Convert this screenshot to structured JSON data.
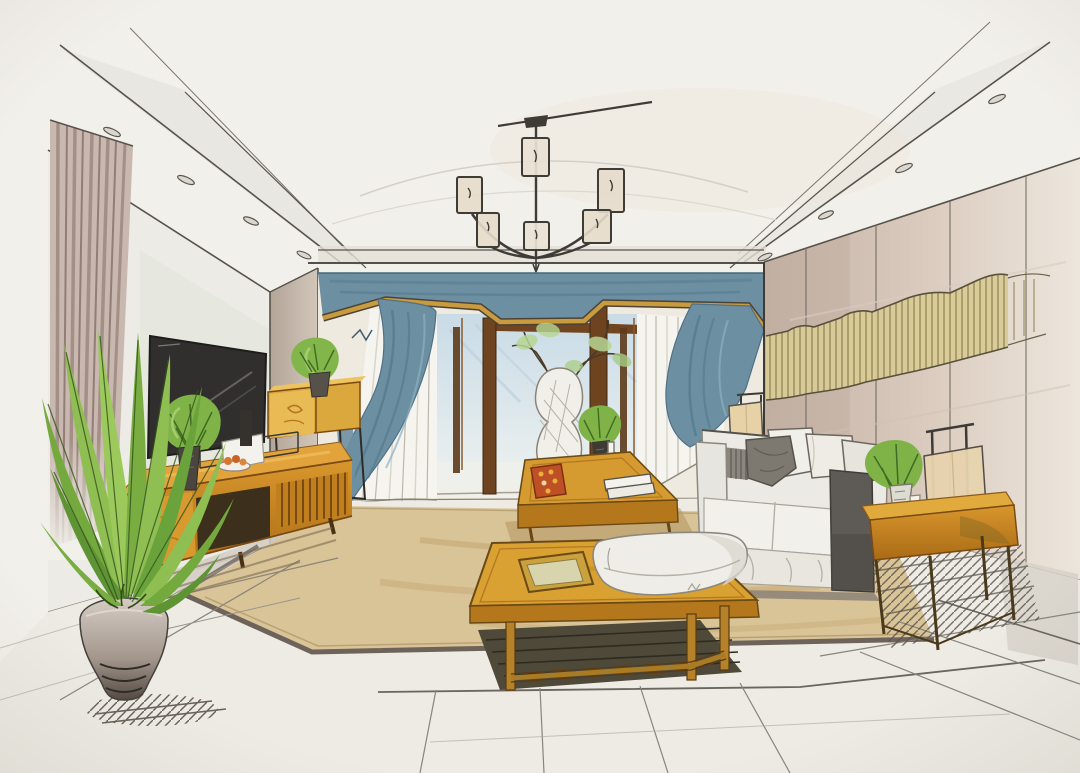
{
  "scene": {
    "title": "Hand-drawn marker-and-ink one-point-perspective sketch of a modern living room interior",
    "labels": {
      "sketch": "Interior design marker rendering",
      "ceiling": "Recessed tray ceiling with perspective lines",
      "downlights": "Rows of recessed ceiling downlights",
      "chandelier": "Modern six-shade chandelier on a center stem",
      "windowWall": "Back wall with full-height glazed doors",
      "valance": "Steel-blue fabric valance with angular gold trim",
      "curtainLeft": "Blue drapery swag, left side",
      "curtainRight": "Blue drapery swag, right side",
      "sheerLeft": "White sheer curtain panel, left",
      "sheerRight": "White sheer curtain panel, right",
      "doorway": "Dark-wood framed sliding glass doorway",
      "sky": "Pale daylight seen through the glazing",
      "pier": "Taupe wall pier beside the window wall",
      "tvWall": "Left wall holding the television",
      "stripedDrape": "Striped floor-length drape at far left",
      "tv": "Wall-mounted flat-screen television",
      "console": "Long amber-wood media console with slatted door",
      "consolePlant": "Leafy plant in dark vase on the console",
      "fruitPlate": "Small plate of fruit on the console",
      "whiteBoard": "White frame leaning on the console",
      "floatingCabinet": "Wall-hung amber cabinet on thin metal legs",
      "cabinetPlant": "Potted plant on the hung cabinet",
      "accentWall": "Right panelled accent wall",
      "waveArt": "Gold rippled ribbon wall sculpture",
      "floorPlant": "Tall leafy floor plant",
      "pot": "Round ceramic planter with shadow hatching",
      "floor": "Large-format pale tile floor",
      "rug": "Tan area rug with dark border band",
      "coffeeTable": "Amber-wood coffee table",
      "vase": "Round crosshatched ceramic vase with branch arrangement",
      "tablePlant": "Green sprigs in a small dark vase",
      "bottle": "Clear glass bottle",
      "books": "Stack of white books",
      "tray": "Red patterned tray",
      "daybed": "Low wide wood daybed table",
      "cushion": "Soft white seat cushion",
      "daybedTray": "Square wood tray on the daybed table",
      "sofa": "Light upholstered sofa with charcoal end panel",
      "pillows": "Gray and white throw pillows",
      "floorLamp": "Square beige shade floor lamp behind sofa",
      "sideTable": "Amber-wood side console on slender legs",
      "tableLamp": "Framed table lamp with fabric shade",
      "sideTablePlant": "Plant, glass vase and bottle on side console",
      "shadows": "Marker shadow hatching on the floor"
    }
  },
  "palette": {
    "paper": "#f2f0eb",
    "ink": "#3f3b36",
    "blue": "#6d8fa2",
    "blueDeep": "#54788c",
    "skyBlue": "#cfdfe8",
    "gold": "#c89b3e",
    "woodLight": "#e8b04a",
    "woodMid": "#d1922d",
    "woodDark": "#a96f1a",
    "brownDark": "#6e431f",
    "green": "#8fbe52",
    "greenDark": "#5e9433",
    "tan": "#d9c498",
    "taupe": "#c0b0a3",
    "cream": "#efe9dd",
    "charcoal": "#5e5b56",
    "grayWash": "#d3cec5",
    "beigeShade": "#e7d2a8"
  }
}
